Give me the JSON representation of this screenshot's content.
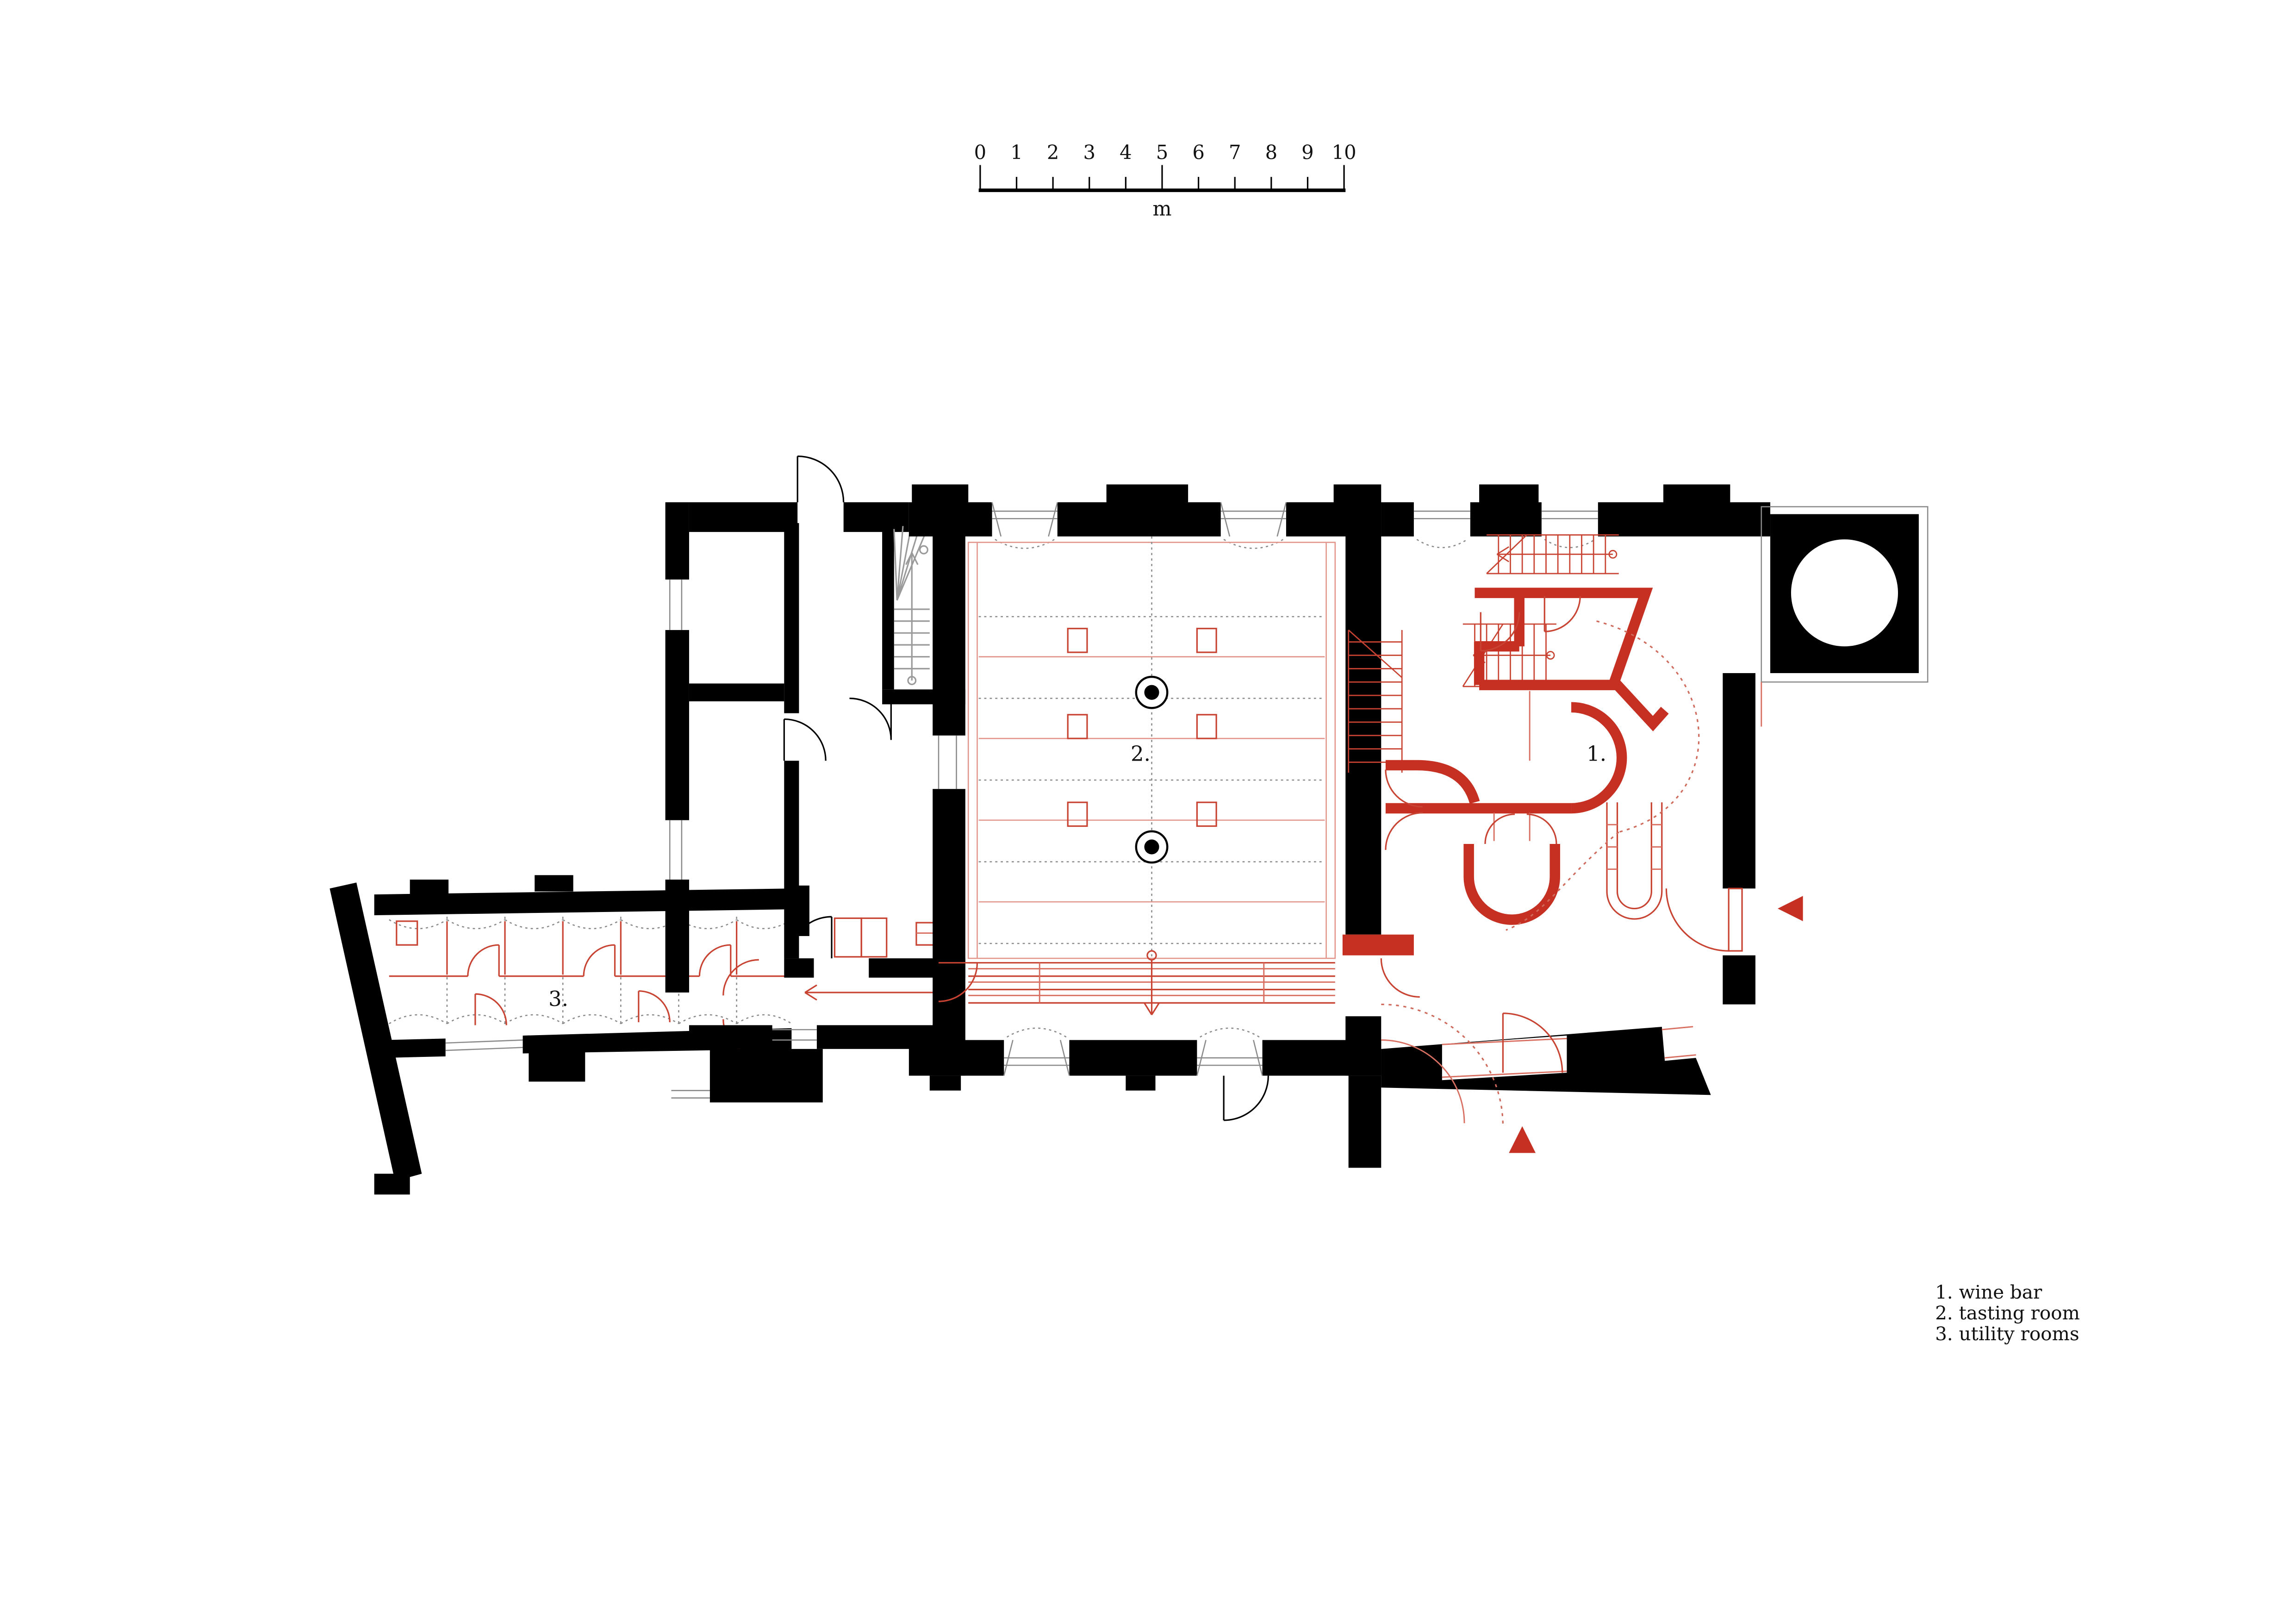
{
  "page": {
    "background": "#ffffff",
    "type": "architectural floor plan"
  },
  "colors": {
    "walls": "#000000",
    "new_intervention_red": "#c53022",
    "thin_red_line": "#c84332",
    "light_red_line": "#e2948a",
    "gray_line": "#8a8a8a"
  },
  "scale_bar": {
    "ticks": [
      "0",
      "1",
      "2",
      "3",
      "4",
      "5",
      "6",
      "7",
      "8",
      "9",
      "10"
    ],
    "unit": "m"
  },
  "plan": {
    "room_labels": [
      {
        "id": "wine-bar",
        "label": "1."
      },
      {
        "id": "tasting-room",
        "label": "2."
      },
      {
        "id": "utility-rooms",
        "label": "3."
      }
    ]
  },
  "legend": {
    "items": [
      {
        "text": "1. wine bar"
      },
      {
        "text": "2. tasting room"
      },
      {
        "text": "3. utility rooms"
      }
    ]
  }
}
